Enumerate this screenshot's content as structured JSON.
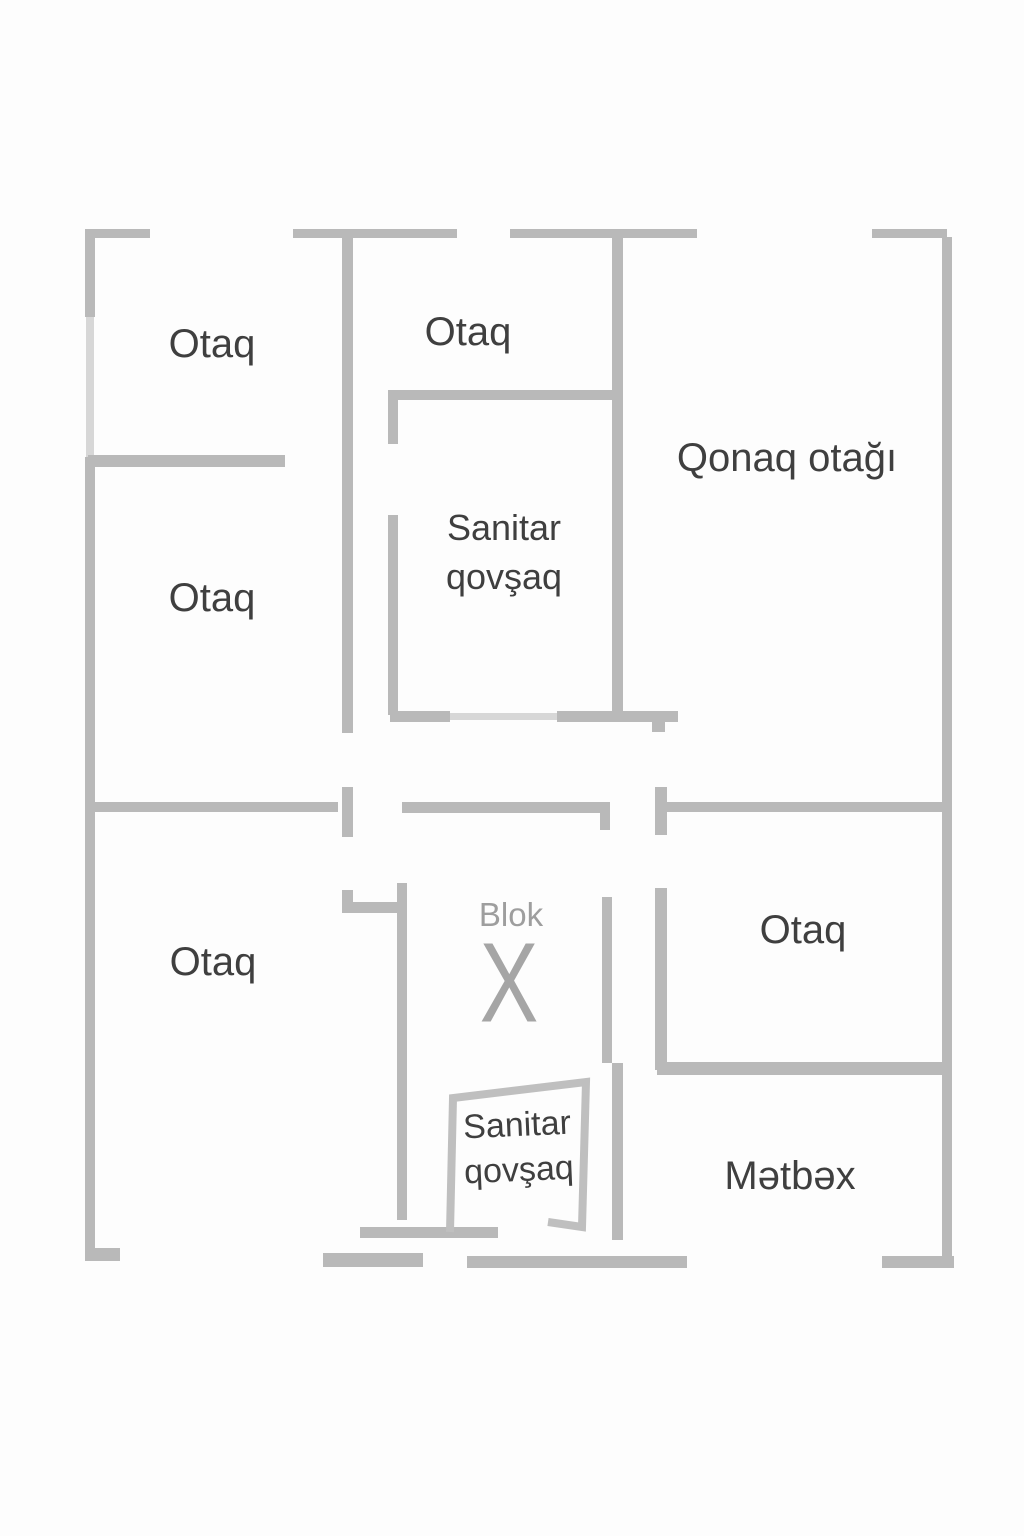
{
  "title": "Mənzil planı",
  "colors": {
    "background": "#fdfdfd",
    "wall": "#b9b9b9",
    "wall_light": "#d7d7d7",
    "label": "#3f3f3f",
    "label_muted": "#9e9e9e"
  },
  "rooms": {
    "otaq_top_left": {
      "label": "Otaq"
    },
    "otaq_top_middle": {
      "label": "Otaq"
    },
    "qonaq_otagi": {
      "label": "Qonaq otağı"
    },
    "otaq_middle_left": {
      "label": "Otaq"
    },
    "sanitar_upper": {
      "line1": "Sanitar",
      "line2": "qovşaq"
    },
    "otaq_bottom_left": {
      "label": "Otaq"
    },
    "blok": {
      "label": "Blok",
      "symbol": "X"
    },
    "otaq_bottom_right": {
      "label": "Otaq"
    },
    "sanitar_lower": {
      "line1": "Sanitar",
      "line2": "qovşaq"
    },
    "metbex": {
      "label": "Mətbəx"
    }
  }
}
